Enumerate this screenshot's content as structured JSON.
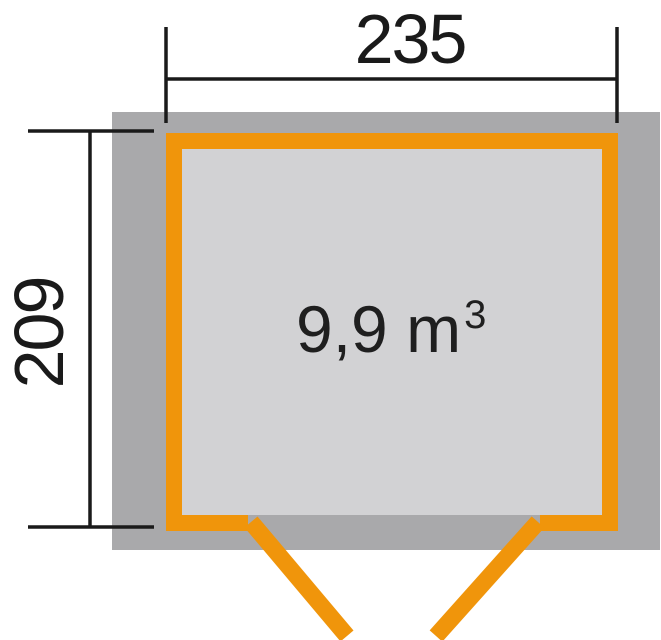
{
  "diagram": {
    "title": "shed-floorplan-top-view",
    "width_dimension": {
      "label": "235"
    },
    "depth_dimension": {
      "label": "209"
    },
    "interior_label": {
      "base": "9,9 m",
      "superscript": "3",
      "full_text": "9,9 m³"
    },
    "colors": {
      "wall_orange": "#f0950b",
      "footprint_gray": "#a9a9ab",
      "interior_gray": "#d2d2d4",
      "dimension_black": "#1a1a1a",
      "background": "#ffffff"
    }
  }
}
